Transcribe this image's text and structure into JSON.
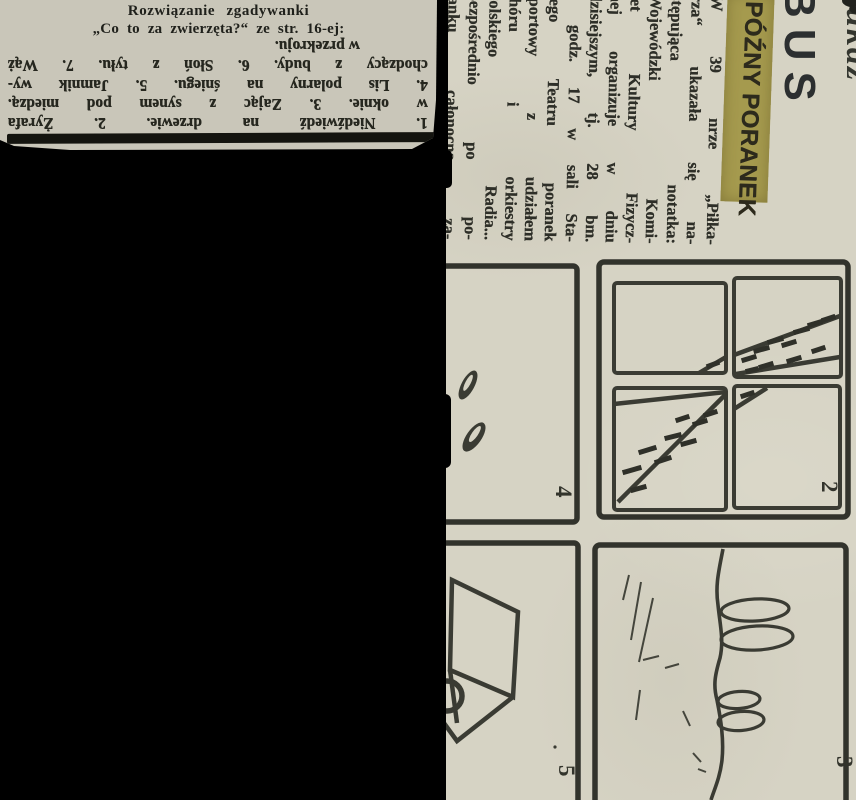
{
  "clipping": {
    "title_line1": "Rozwiązanie zgadywanki",
    "title_line2": "„Co to za zwierzęta?“ ze str. 16-ej:",
    "answers_upside_down": [
      "w przekroju.",
      "chodzący z budy. 6. Słoń z tyłu. 7. Wąż",
      "4. Lis polarny na śniegu. 5. Jamnik wy-",
      "w oknie. 3. Zając z synem pod miedzą.",
      "1. Niedźwiedź na drzewie. 2. Żyrafa"
    ]
  },
  "strip": {
    "masthead_partial": "BUS",
    "masthead_script_partial": "ukaz",
    "headline": "PÓŹNY PORANEK",
    "article_lines": [
      "W 39 nrze „Piłka-",
      "rza“ ukazała się na-",
      "stępująca notatka:",
      "Wojewódzki Komi-",
      "tet Kultury Fizycz-",
      "nej organizuje w dniu",
      "dzisiejszym, tj. 28 bm.",
      "o godz. 17 w sali Sta-",
      "rego Teatru poranek",
      "sportowy z udziałem",
      "chóru i orkiestry",
      "Polskiego Radia...",
      "Bezpośrednio po po-",
      "ranku całonocna za-"
    ],
    "panel_numbers": {
      "top_left": "4",
      "top_right": "2",
      "bottom_left": "5",
      "bottom_right": "3"
    }
  },
  "colors": {
    "background": "#000000",
    "clipping_paper": "#c9c6b9",
    "strip_paper": "#d6d3c4",
    "highlight_band": "#a59a4e",
    "ink": "#2e2f28",
    "divider_bar": "#14140f"
  }
}
